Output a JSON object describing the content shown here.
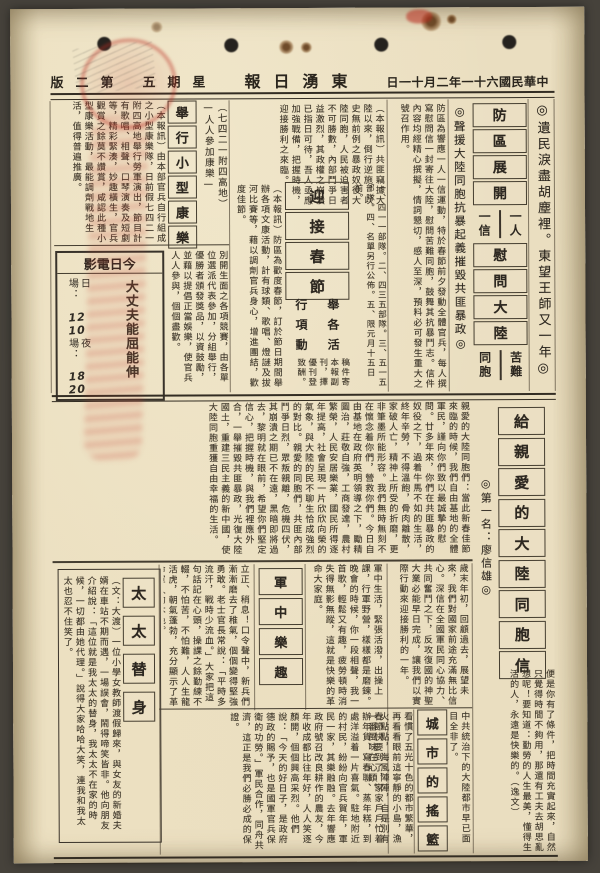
{
  "colors": {
    "paper": "#e9ddbf",
    "ink": "#3d362a",
    "ink-dark": "#2a251d",
    "stamp-red": "#b83a2c"
  },
  "masthead": {
    "date": "中華民國六十一年二月十一日",
    "title": "東湧日報",
    "weekday": "星期五",
    "edition": "第二版"
  },
  "headlines": {
    "slogan": "◎遺民淚盡胡塵裡。東望王師又一年◎",
    "campaign1": "防區展開",
    "campaign_pair1_right": "一人",
    "campaign_pair1_left": "一信",
    "campaign2": "慰問大陸",
    "campaign_pair2_right": "苦難",
    "campaign_pair2_left": "同胞",
    "support": "◎聲援大陸同胞抗暴起義摧毀共匪暴政◎",
    "spring": "迎接春節",
    "spring_sub": [
      "舉行",
      "各項",
      "活動"
    ],
    "recreation": "舉行小型康樂",
    "recreation_note": "（七四二一附四高地）\n—人人參加康樂—",
    "letter": "給親愛的大陸同胞信",
    "letter_byline": "◎第一名：廖信雄◎",
    "wife": "太太替身",
    "army": "軍中樂趣",
    "city": "城市的搖籃"
  },
  "cinema": {
    "header": "今日電影",
    "title": "大丈夫能屈能伸",
    "day_label": "日場：",
    "day_h": "12",
    "day_m": "10",
    "night_label": "夜場：",
    "night_h": "18",
    "night_m": "20"
  },
  "articles": {
    "top_right": "防區為響應一人一信運動，特於春節前夕發動全體官兵，每人撰寫慰問信一封寄往大陸，慰問苦難同胞，鼓舞其抗暴鬥志。信件內容均經精心撰擬，情詞懇切，感人至深，預料必可發生重大之號召作用。",
    "mid_top": "（本報訊）共匪竊據大陸以來，倒行逆施，以史無前例之暴政奴役大陸同胞，人民被迫害者不可勝數，內部鬥爭日益激烈，其政權之崩潰已指日可待，吾人亟應加強戰備，把握時機，迎接勝利之來臨。",
    "mid_left": "（本報訊）防區為歡度春節，訂於節日期間舉辦各項文康活動，計有球類、歌唱、燈謎及拔河比賽等，藉以調劑官兵身心，增進團結，歡度佳節。",
    "mid_list": "一、四一一部隊。二、四三五部隊。三、五一五部隊。四、名單另行公佈。五、限元月十五日前。",
    "mid_note": "稿件寄本報副刊，擇優刊登致酬。",
    "left_top": "（本報訊）由本部官兵自行組成之小型康樂隊，日前假七四二一附四高地舉行勞軍演出，節目計有歌唱、相聲、口琴演奏及短劇等，精彩緊湊，妙趣橫生，官兵觀賞之餘莫不讚賞，咸認此種小型康樂活動，最能調劑戰地生活，值得普遍推廣。",
    "left_mid": "別開生面之各項競賽，由各單位選派代表參加，分組舉行，優勝者頒發獎品，以資鼓勵，並藉以提倡正當娛樂，使官兵人人參與，個個盡歡。",
    "letter_body": "親愛的大陸同胞們：當此新春佳節來臨的時候，我們自由基地的全體軍民，謹向你們致以最誠摯的慰問。廿多年來，你們在共匪暴政的奴役之下，過着牛馬不如的生活，終年辛勞，不得溫飽，骨肉離散，家破人亡，精神上所受的折磨，更非筆墨所能形容。我們無時無刻不在懷念着你們，營救你們。今日自由基地在政府英明領導之下，勵精圖治，莊敬自強，工商發達，農村繁榮，人民安居樂業，國民所得逐年提高，社會呈現一片欣欣向榮的氣象，與大陸的民不聊生恰成強烈的對比。親愛的同胞們，共匪內部鬥爭日烈，眾叛親離，危機四伏，其崩潰之期已不在遠，黑暗即將過去，黎明就在眼前，希望你們堅定信心，把握時機，與我們裡應外合，一舉摧毀共匪暴政，光復大陸國土，重建三民主義的新中國，使大陸同胞重獲自由幸福的生活。",
    "wife_story": "（文：大渡）一位小學女教師渡假歸來，與女友的新婚夫婿在車站不期而遇，一場誤會，鬧得啼笑皆非。他向朋友介紹說：「這位就是我太太的替身，我太太不在家的時候，一切都由她代理。」說得大家哈哈大笑，連我和我太太也忍不住笑了。",
    "drill": "立正、稍息！口令聲中，新兵們漸漸磨去了稚氣，個個變得堅強勇敢。老士官長常說：「平時多流汗，戰時少流血。」大家把這句話記在心頭，操課之餘勤練不輟，不怕苦，不怕難，人人生龍活虎，朝氣蓬勃，充分顯示了革命軍人的本色。",
    "army_story": "軍中生活，緊張活潑，出操上課，行軍野營，樣樣都是磨鍊。晚會的時候，你一段相聲，我一首歌，輕鬆又有趣，疲勞頓時消失得無影無蹤，這就是快樂的革命大家庭。",
    "right_mid": "歲末年初，回顧過去，展望未來，我們對國家前途充滿無比信心。深信在全國軍民同心協力、共同奮鬥之下，反攻復國的神聖大業必能早日完成，讓我們以實際行動來迎接勝利的一年。",
    "bottom_mid": "春節快要到了，家家戶戶忙着辦年貨、寫春聯、蒸年糕，到處洋溢着一片喜氣。駐地附近的村民，紛紛向官兵賀年，軍民一家，其樂融融。去年響應政府號召改良耕作的農友，今年收成都比往年好，人人笑逐顏開，個個興高采烈。他們說：「今天的好日子，是政府德政的賜予，也是國軍官兵保衛的功勞。」軍民合作，同舟共濟，這正是我們必勝必成的保證。",
    "city_left": "看慣了五光十色的都市繁華，再看看眼前這寧靜的小島，漁火點點，海風陣陣，自是別有一番風味在心頭。",
    "city_right": "中共統治下的大陸都市早已面目全非了。",
    "letter_cont": "便是你有了條件，把時間充實起來，自然只覺得時間不夠用，那還有工夫去胡思亂想呢！要知道：勤勞的人生最美，懂得生活的人，永遠是快樂的。（逸文）"
  }
}
